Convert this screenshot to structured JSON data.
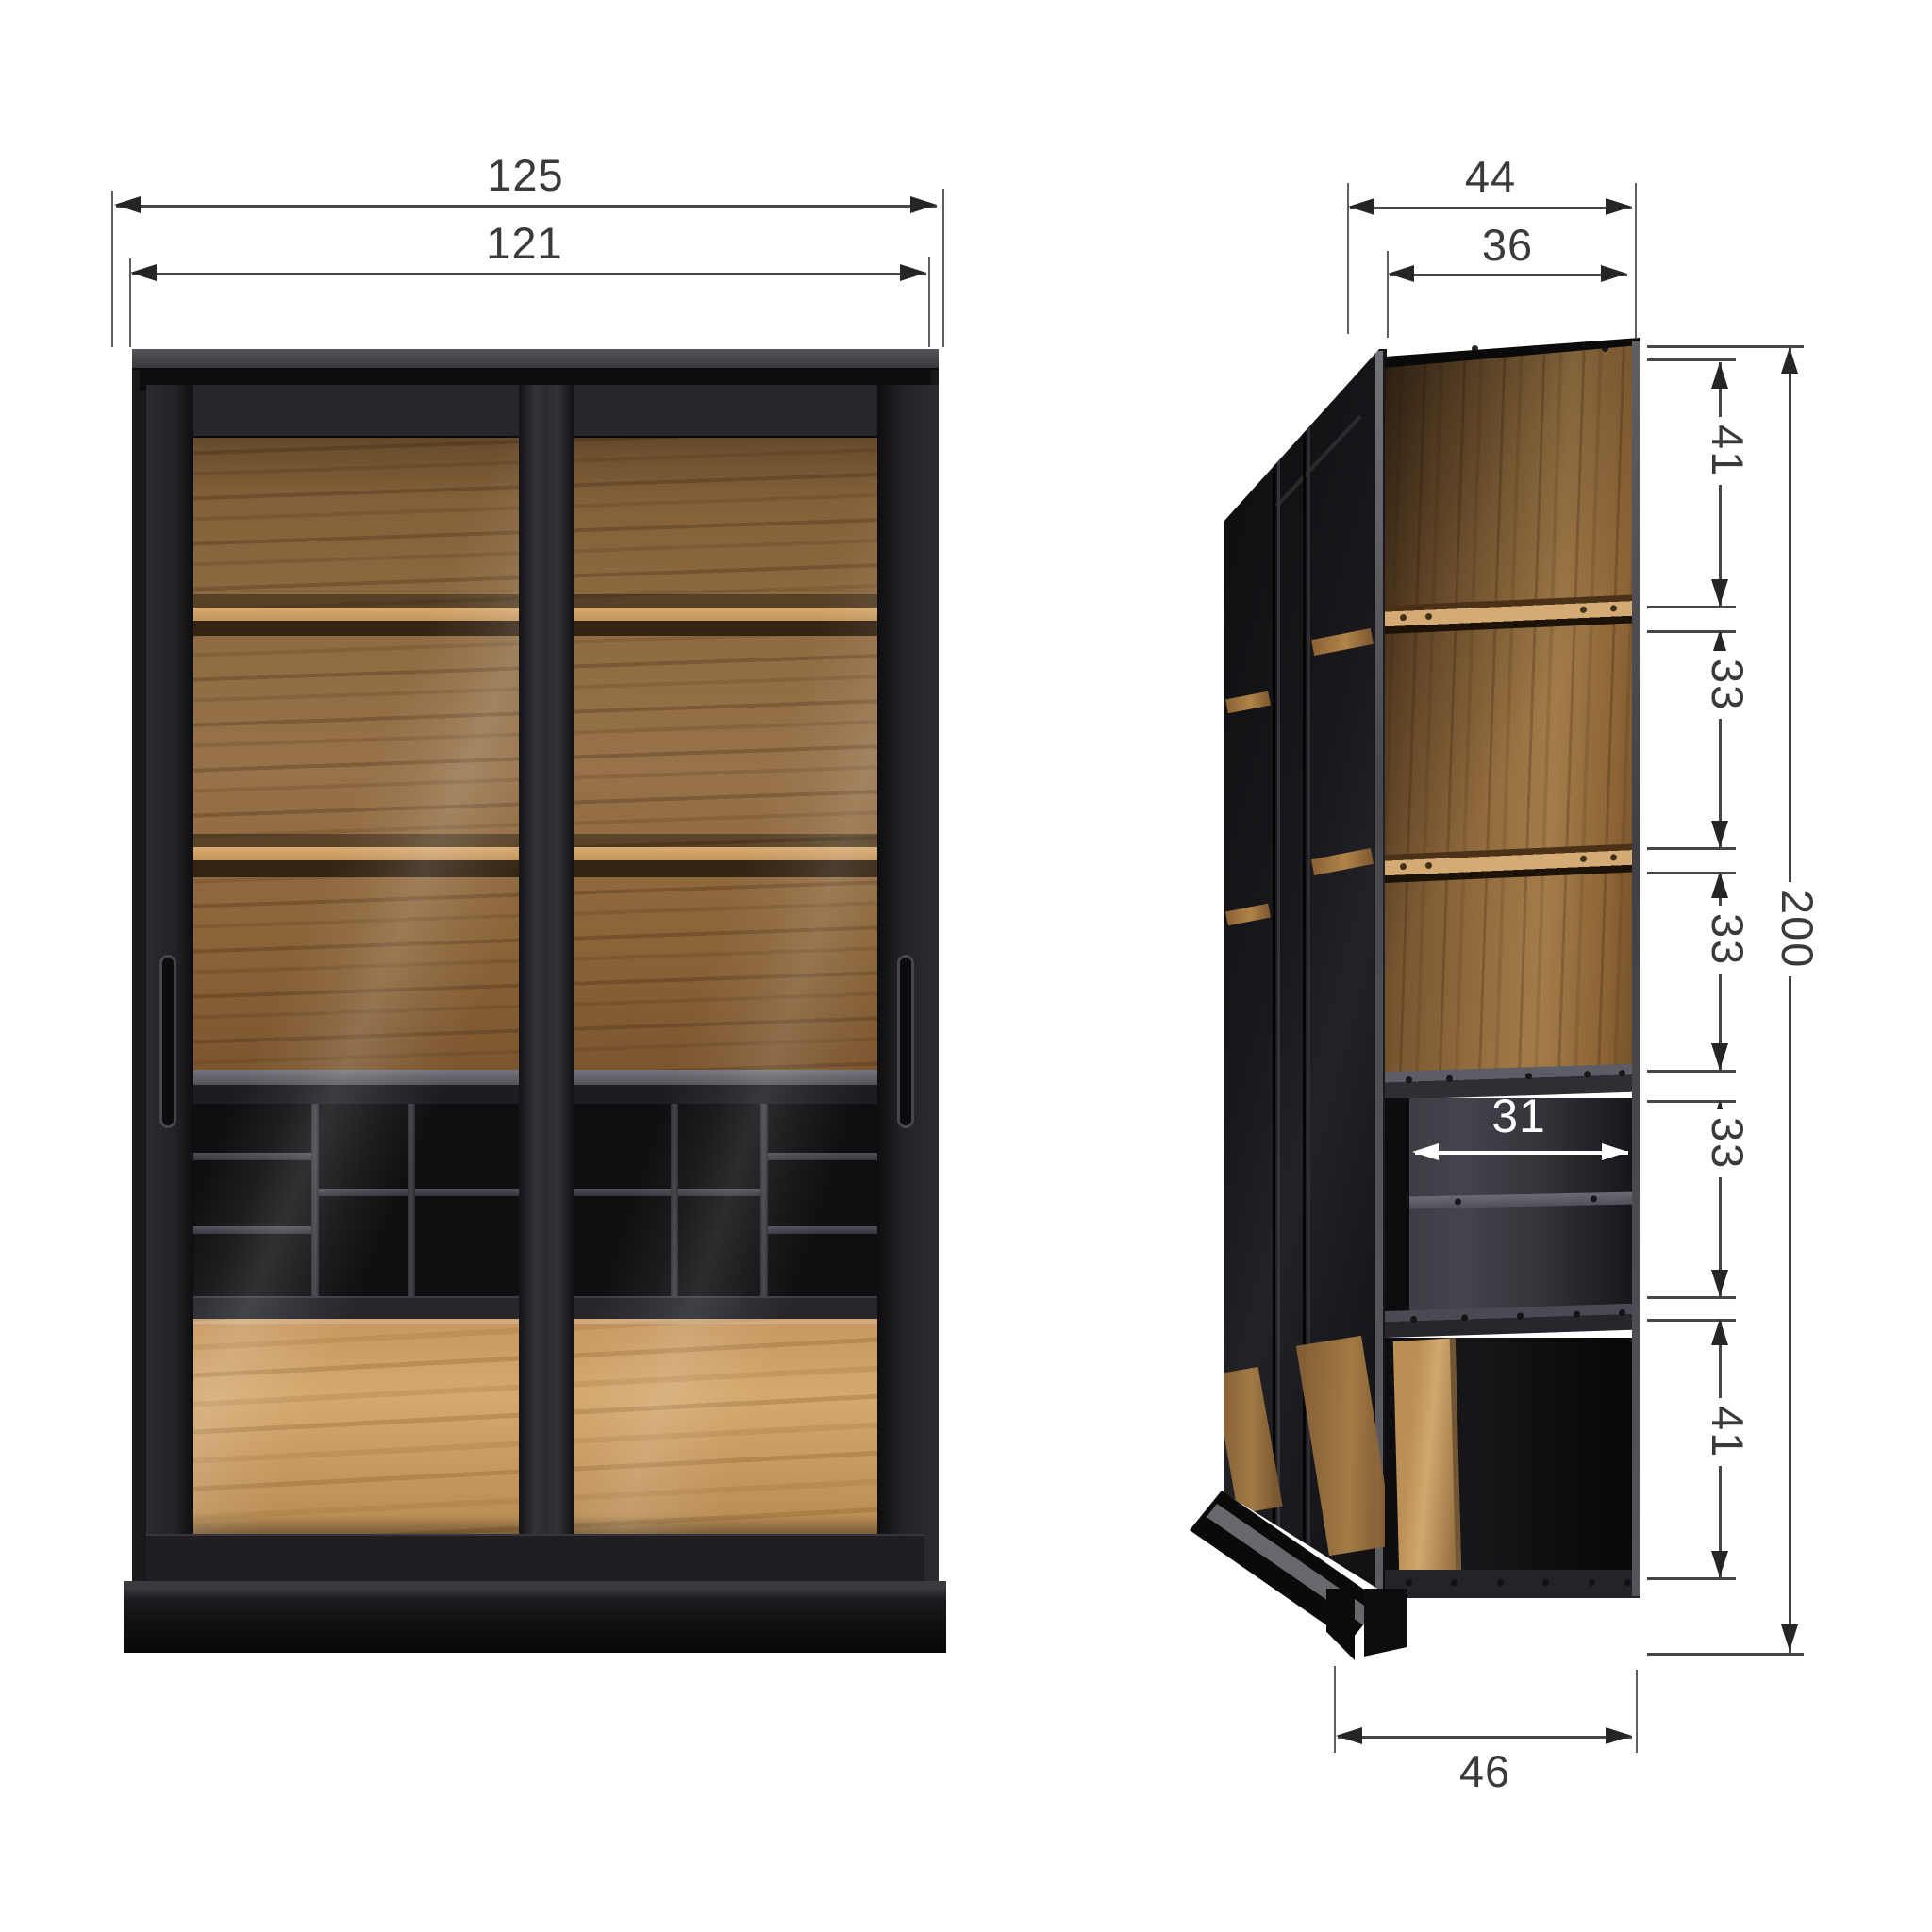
{
  "diagram": {
    "type": "furniture-dimension-drawing",
    "subject": "display cabinet with two sliding glass doors, oak interior, black frame",
    "views": {
      "left": "front elevation",
      "right": "side cutaway view"
    },
    "dimensions_cm": {
      "width_total": "125",
      "width_inner": "121",
      "depth_total": "44",
      "depth_inner": "36",
      "segment_top": "41",
      "segment_2": "33",
      "segment_3": "33",
      "segment_4": "33",
      "segment_bottom": "41",
      "height_total": "200",
      "interior_depth": "31",
      "base_depth": "46"
    },
    "colors": {
      "dimension_line": "#46464a",
      "dimension_text": "#3a3a3a",
      "cabinet_black": "#1a1a1d",
      "oak_light": "#c99a61",
      "oak_dark": "#8a6438",
      "interior_white_dim": "#ffffff"
    }
  }
}
